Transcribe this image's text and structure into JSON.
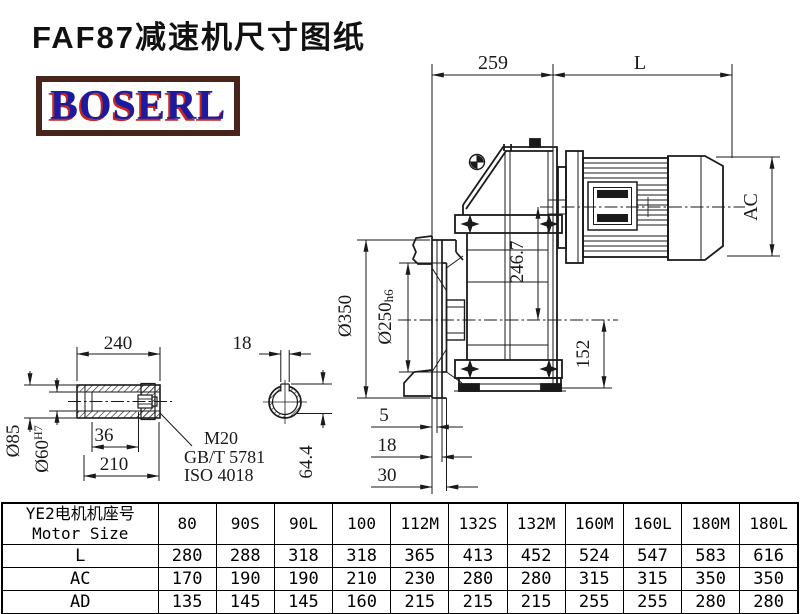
{
  "title": "FAF87减速机尺寸图纸",
  "logo": {
    "text": "BOSERL"
  },
  "colors": {
    "line": "#1a1a1a",
    "logo_blue": "#1c1a9e",
    "logo_red": "#c42721",
    "logo_border_brown": "#47241c"
  },
  "drawing": {
    "views": [
      "gearbox-with-motor-side-view",
      "hollow-shaft-detail",
      "shaft-cross-section"
    ],
    "dims": {
      "housing_width": "259",
      "motor_length": "L",
      "motor_diameter": "AC",
      "center_height": "246.7",
      "base_to_center": "152",
      "flange_od": "Ø350",
      "spigot_d": "Ø250",
      "spigot_tol": "h6",
      "flange_step1": "5",
      "flange_step2": "18",
      "flange_step3": "30",
      "sleeve_length": "240",
      "hub_length": "210",
      "thread_depth": "36",
      "sleeve_od": "Ø85",
      "bore_d": "Ø60",
      "bore_tol": "H7",
      "key_width": "18",
      "bore_key_height": "64.4",
      "screw": "M20",
      "screw_std_gb": "GB/T 5781",
      "screw_std_iso": "ISO 4018"
    }
  },
  "table": {
    "header_cn": "YE2电机机座号",
    "header_en": "Motor Size",
    "columns": [
      "80",
      "90S",
      "90L",
      "100",
      "112M",
      "132S",
      "132M",
      "160M",
      "160L",
      "180M",
      "180L"
    ],
    "rows": [
      {
        "label": "L",
        "values": [
          "280",
          "288",
          "318",
          "318",
          "365",
          "413",
          "452",
          "524",
          "547",
          "583",
          "616"
        ]
      },
      {
        "label": "AC",
        "values": [
          "170",
          "190",
          "190",
          "210",
          "230",
          "280",
          "280",
          "315",
          "315",
          "350",
          "350"
        ]
      },
      {
        "label": "AD",
        "values": [
          "135",
          "145",
          "145",
          "160",
          "215",
          "215",
          "215",
          "255",
          "255",
          "280",
          "280"
        ]
      }
    ]
  }
}
